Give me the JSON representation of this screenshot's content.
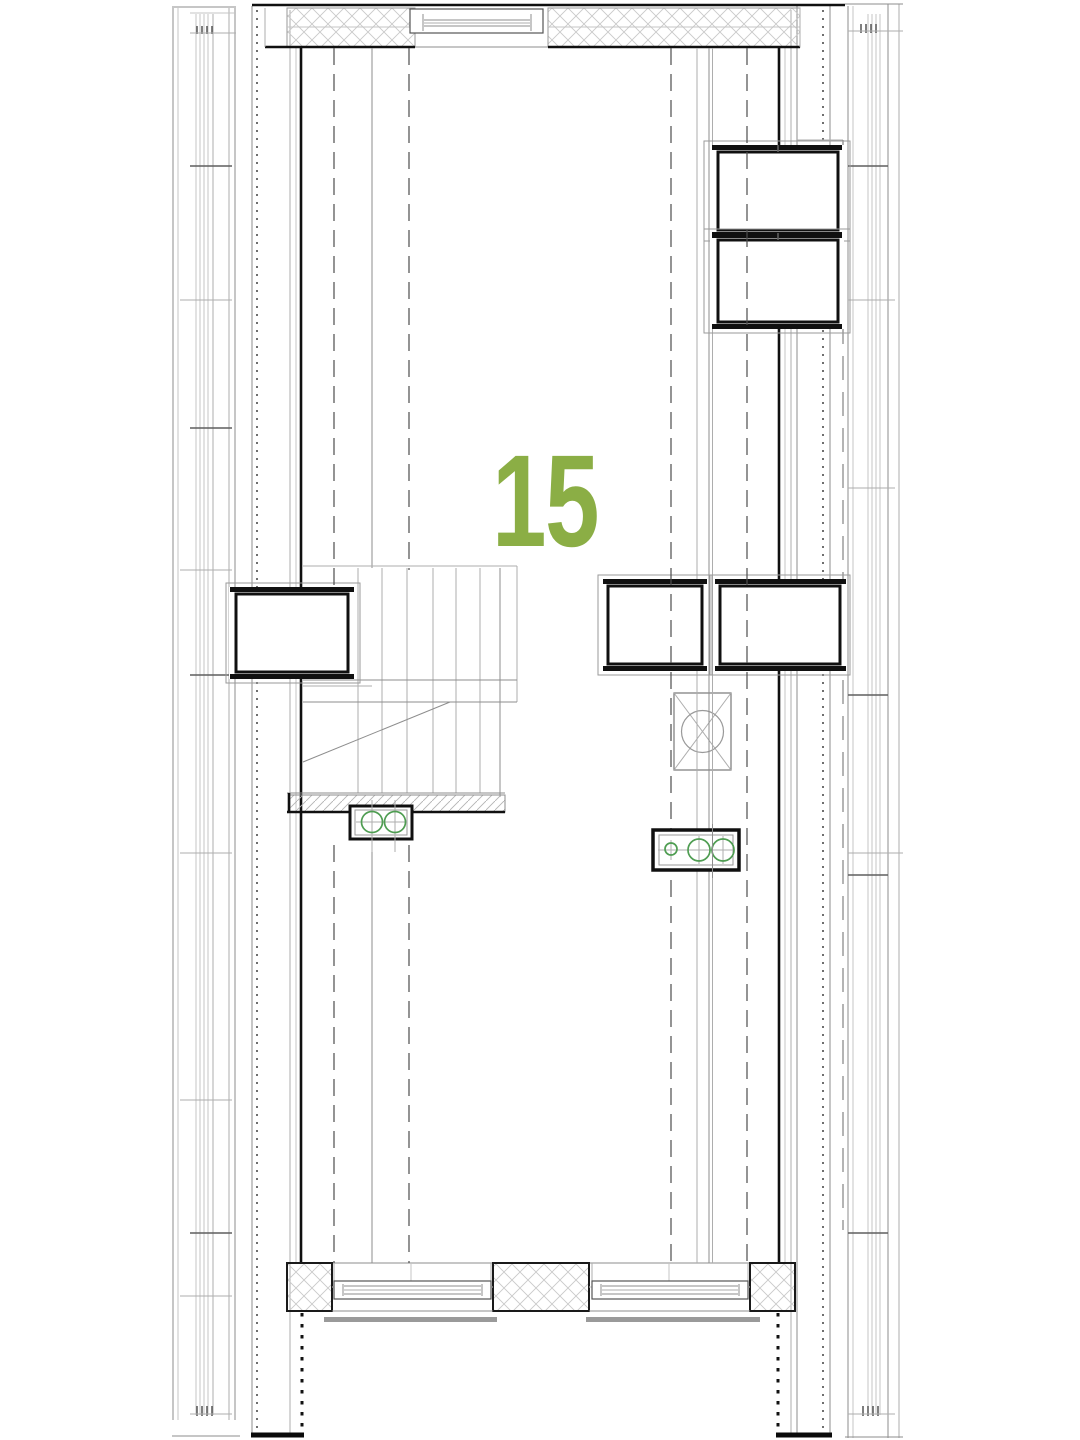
{
  "plan": {
    "unit_number": "15"
  },
  "colors": {
    "unit_number_green": "#8bae45",
    "fixture_green": "#4f9d52",
    "wall_line_black": "#101010",
    "medium_line_gray": "#8d8d8d",
    "light_line_gray": "#c4c4c4",
    "hatch_gray": "#c9c9c9",
    "background": "#ffffff"
  }
}
